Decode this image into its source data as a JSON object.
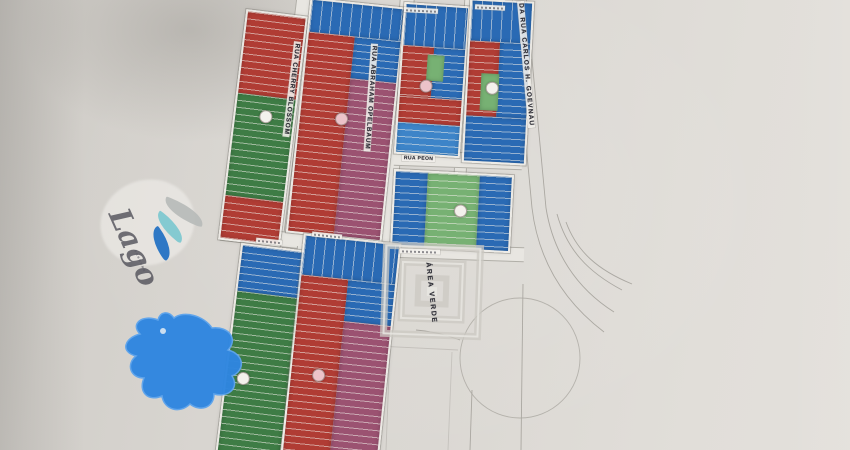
{
  "photo": {
    "streets": {
      "cherry": "RUA CHERRY BLOSSOM",
      "abraham": "RUA ABRAHAM OPELBAUM",
      "peon": "RUA PEON",
      "carlos": "DA RUA CARLOS H. GOEVNAU"
    },
    "labels": {
      "area_verde": "ÁREA VERDE",
      "logo_script": "Lago"
    },
    "colors": {
      "lot_red": "#b03c34",
      "lot_blue": "#2a6ab4",
      "lot_blue_light": "#3d84c8",
      "lot_green": "#3e7c45",
      "lot_green_light": "#77b173",
      "lot_purple": "#9b5271",
      "lake_blue": "#2f86e0",
      "line_gray": "#8f8c85",
      "label_ink": "#2e2e36",
      "paper": "#d8d5d0"
    }
  }
}
